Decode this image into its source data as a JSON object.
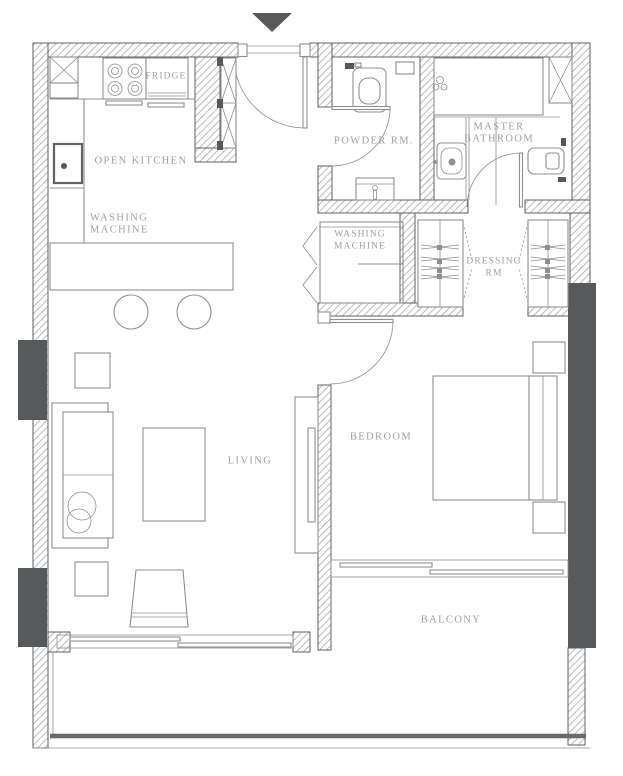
{
  "plan": {
    "rooms": {
      "open_kitchen": {
        "label": "OPEN KITCHEN"
      },
      "fridge": {
        "label": "FRIDGE"
      },
      "washing_machine_kitchen": {
        "label_line1": "WASHING",
        "label_line2": "MACHINE"
      },
      "powder_room": {
        "label": "POWDER RM."
      },
      "master_bathroom": {
        "label_line1": "MASTER",
        "label_line2": "BATHROOM"
      },
      "washing_machine_closet": {
        "label_line1": "WASHING",
        "label_line2": "MACHINE"
      },
      "dressing_room": {
        "label_line1": "DRESSING",
        "label_line2": "RM"
      },
      "living": {
        "label": "LIVING"
      },
      "bedroom": {
        "label": "BEDROOM"
      },
      "balcony": {
        "label": "BALCONY"
      }
    },
    "colors": {
      "background": "#ffffff",
      "wall_line": "#5f6164",
      "hatch_line": "#a8abad",
      "column_fill": "#58595b",
      "furniture_line": "#8d9093",
      "label_text": "#9ca1a5",
      "railing": "#67696b"
    }
  }
}
